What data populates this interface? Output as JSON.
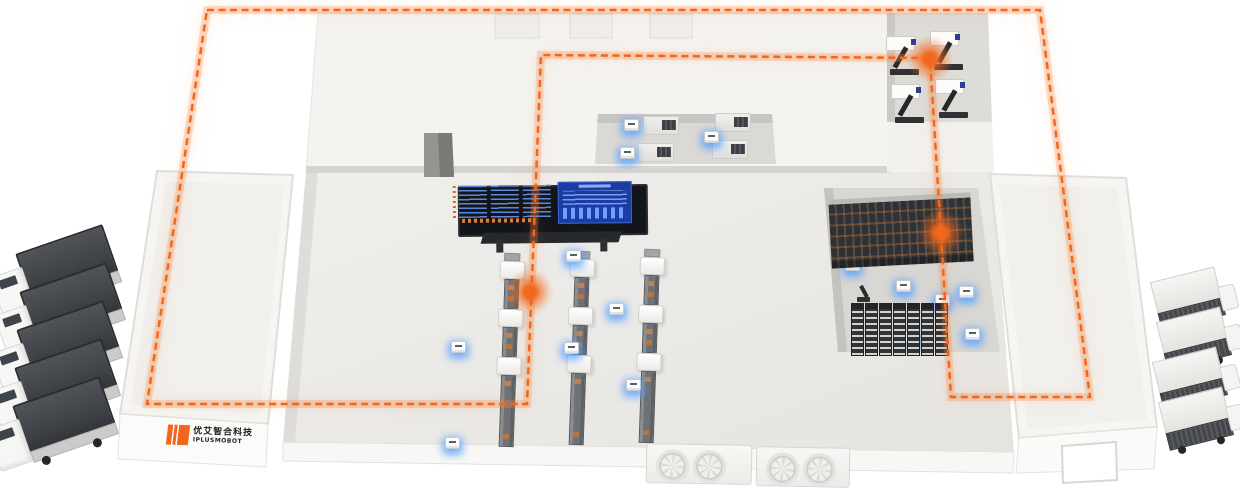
{
  "meta": {
    "title": "Smart factory intralogistics overview (isometric illustration)",
    "canvas": {
      "width": 1240,
      "height": 488
    }
  },
  "branding": {
    "logo_cn": "优艾智合科技",
    "logo_en": "IPLUSMOBOT",
    "logo_color": "#f2671c"
  },
  "palette": {
    "route_orange": "#f2671c",
    "route_glow": "#f78c46",
    "background": "#ffffff",
    "floor_light": "#edebe8",
    "floor_gray": "#d8d7d3",
    "wall_white": "#f5f4f1",
    "screen_dark": "#12151b",
    "screen_blue": "#1b3da3",
    "screen_line_blue": "#5b8ddb",
    "agv_glow_blue": "#4f9bff",
    "truck_cargo_gray": "#43464a",
    "rack_dark": "#2f3133"
  },
  "route": {
    "style": "dashed-loop",
    "closed": true,
    "points": [
      [
        207,
        10
      ],
      [
        1040,
        10
      ],
      [
        1090,
        397
      ],
      [
        951,
        397
      ],
      [
        930,
        58
      ],
      [
        541,
        55
      ],
      [
        527,
        404
      ],
      [
        147,
        404
      ]
    ]
  },
  "nodes": [
    {
      "name": "route-node-assembly-line",
      "x": 530,
      "y": 292
    },
    {
      "name": "route-node-machining-room",
      "x": 930,
      "y": 59
    },
    {
      "name": "route-node-rack-zone",
      "x": 941,
      "y": 233
    }
  ],
  "scene": {
    "trucks_left": [
      {
        "x": -6,
        "y": 248
      },
      {
        "x": -2,
        "y": 286
      },
      {
        "x": -5,
        "y": 324
      },
      {
        "x": -7,
        "y": 362
      },
      {
        "x": -9,
        "y": 400
      }
    ],
    "trucks_right": [
      {
        "x": 1150,
        "y": 272
      },
      {
        "x": 1156,
        "y": 312
      },
      {
        "x": 1152,
        "y": 352
      },
      {
        "x": 1158,
        "y": 392
      }
    ],
    "cnc_machines": [
      {
        "x": 886,
        "y": 36
      },
      {
        "x": 930,
        "y": 31
      },
      {
        "x": 891,
        "y": 84
      },
      {
        "x": 935,
        "y": 79
      }
    ],
    "corridor_machines": [
      {
        "x": 643,
        "y": 116
      },
      {
        "x": 715,
        "y": 113
      },
      {
        "x": 638,
        "y": 143
      },
      {
        "x": 712,
        "y": 140
      }
    ],
    "production_lines": [
      {
        "x": 497,
        "y": 253
      },
      {
        "x": 567,
        "y": 251
      },
      {
        "x": 637,
        "y": 249
      }
    ],
    "line_pattern": [
      "cap",
      "machine",
      "conveyor",
      "machine",
      "conveyor",
      "machine",
      "conveyor-long"
    ],
    "agvs": [
      {
        "x": 624,
        "y": 119
      },
      {
        "x": 620,
        "y": 147
      },
      {
        "x": 704,
        "y": 131
      },
      {
        "x": 566,
        "y": 250
      },
      {
        "x": 609,
        "y": 303
      },
      {
        "x": 564,
        "y": 342
      },
      {
        "x": 451,
        "y": 341
      },
      {
        "x": 626,
        "y": 379
      },
      {
        "x": 445,
        "y": 437
      },
      {
        "x": 845,
        "y": 259
      },
      {
        "x": 896,
        "y": 280
      },
      {
        "x": 935,
        "y": 294
      },
      {
        "x": 959,
        "y": 286
      },
      {
        "x": 905,
        "y": 331
      },
      {
        "x": 965,
        "y": 328
      }
    ],
    "rack_row_upper": {
      "x": 830,
      "y": 196,
      "width": 142,
      "height": 64
    },
    "rack_modules_lower": {
      "x": 851,
      "y": 303,
      "count": 7,
      "step": 14
    },
    "robot_arm": {
      "x": 856,
      "y": 285
    },
    "fan_units": [
      {
        "x": 646,
        "y": 444,
        "width": 104
      },
      {
        "x": 756,
        "y": 447,
        "width": 92
      }
    ]
  }
}
